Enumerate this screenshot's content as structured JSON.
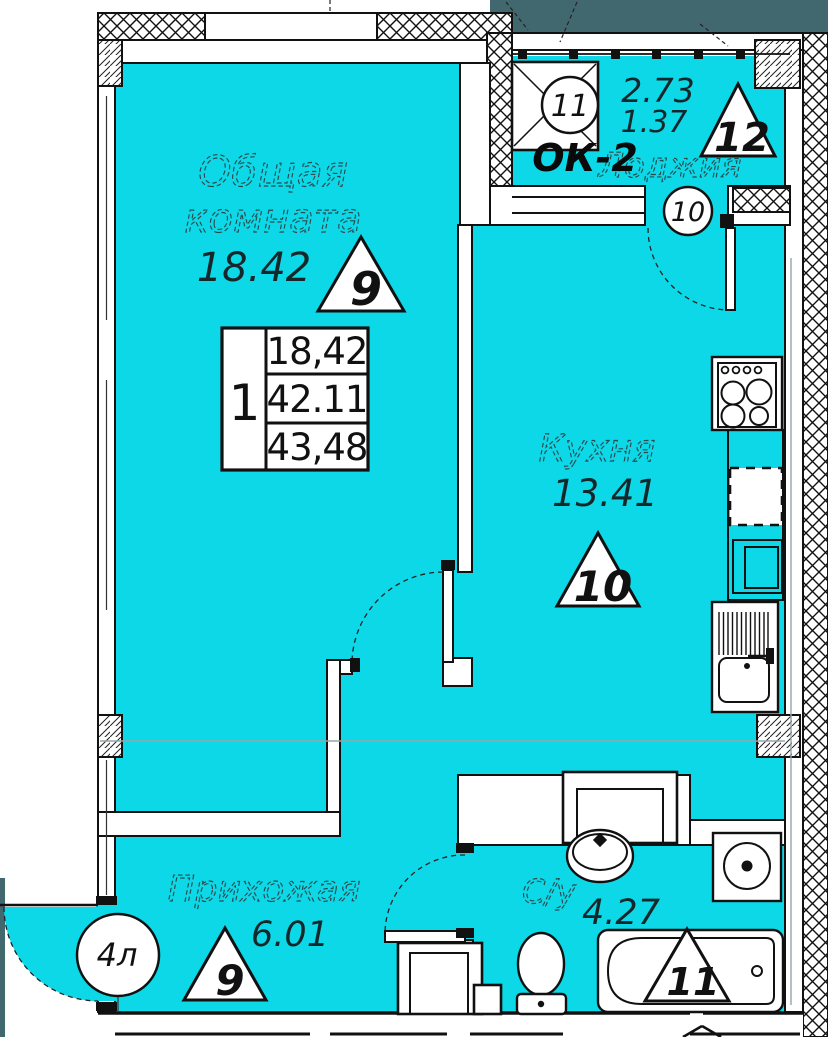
{
  "colors": {
    "floor": "#0cd8e7",
    "outside": "#42686f"
  },
  "living": {
    "line1": "Общая",
    "line2": "комната",
    "area": "18.42",
    "mark": "9"
  },
  "kitchen": {
    "name": "Кухня",
    "area": "13.41",
    "mark": "10"
  },
  "hall": {
    "name": "Прихожая",
    "area": "6.01",
    "mark": "9"
  },
  "bath": {
    "name": "С/у",
    "area": "4.27",
    "mark": "11"
  },
  "loggia": {
    "name": "Лоджия",
    "area_total": "2.73",
    "area_reduced": "1.37",
    "mark": "12",
    "window_label": "ОК-2",
    "window_mark": "11",
    "door_mark": "10"
  },
  "entrance": {
    "mark": "4л"
  },
  "table": {
    "flat": "1",
    "row1": "18,42",
    "row2": "42.11",
    "row3": "43,48"
  }
}
